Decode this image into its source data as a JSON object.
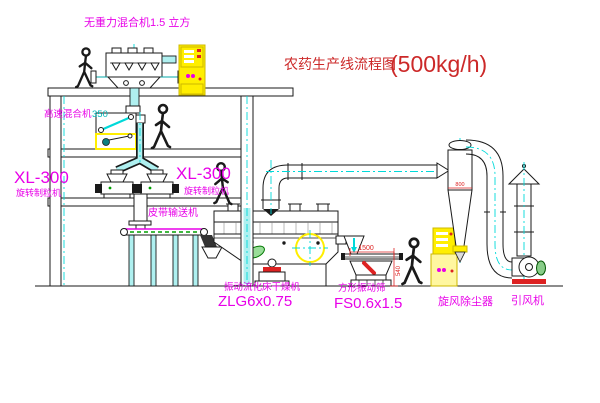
{
  "title": {
    "text": "农药生产线流程图",
    "capacity": "(500kg/h)"
  },
  "equipment": {
    "gravity_mixer": {
      "label": "无重力混合机1.5 立方"
    },
    "high_speed_mixer": {
      "label": "高速混合机",
      "size": "350"
    },
    "granulator_left": {
      "model": "XL-300",
      "name": "旋转制粒机"
    },
    "granulator_right": {
      "model": "XL-300",
      "name": "旋转制粒机"
    },
    "belt_conveyor": {
      "label": "皮带输送机"
    },
    "fluid_bed_dryer": {
      "name": "振动流化床干燥机",
      "model": "ZLG6x0.75"
    },
    "vibrating_screen": {
      "name": "方形振动筛",
      "model": "FS0.6x1.5"
    },
    "cyclone": {
      "name": "旋风除尘器"
    },
    "fan": {
      "name": "引风机"
    }
  },
  "dimensions": {
    "cyclone_width": "800",
    "screen_length": "1500",
    "screen_height": "540"
  },
  "colors": {
    "label_magenta": "#e800e8",
    "title_red": "#cc2929",
    "dimension_red": "#dd2222",
    "centerline_cyan": "#00d9d9",
    "highlight_yellow": "#ffee00",
    "line_black": "#1a1a1a"
  }
}
